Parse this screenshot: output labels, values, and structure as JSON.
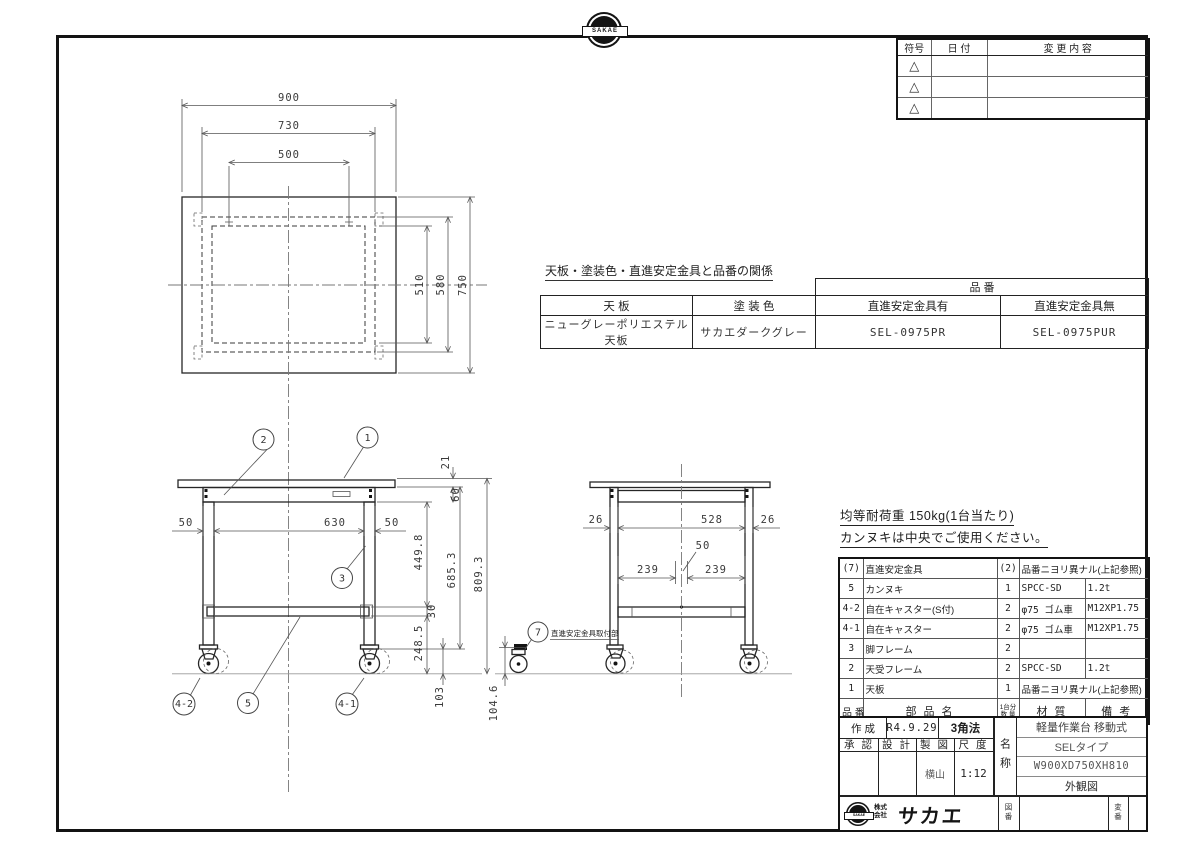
{
  "sheet": {
    "brand_logo_text": "SAKAE",
    "revision_table": {
      "col_symbol": "符号",
      "col_date": "日  付",
      "col_change": "変 更 内 容",
      "symbol_mark": "△"
    },
    "relation": {
      "caption": "天板・塗装色・直進安定金具と品番の関係",
      "part_no_header": "品  番",
      "col_top": "天 板",
      "col_paint": "塗 装 色",
      "col_with": "直進安定金具有",
      "col_without": "直進安定金具無",
      "top_value": "ニューグレーポリエステル天板",
      "paint_value": "サカエダークグレー",
      "with_value": "SEL-0975PR",
      "without_value": "SEL-0975PUR"
    },
    "notes": {
      "line1": "均等耐荷重  150kg(1台当たり)",
      "line2": "カンヌキは中央でご使用ください。"
    },
    "parts": {
      "h_no": "品 番",
      "h_name": "部 品 名",
      "h_qty1": "1台分",
      "h_qty2": "数 量",
      "h_mat": "材  質",
      "h_rem": "備  考",
      "rows": [
        {
          "no": "(7)",
          "name": "直進安定金具",
          "qty": "(2)",
          "mat": "品番ニヨリ異ナル(上記参照)",
          "rem": ""
        },
        {
          "no": "5",
          "name": "カンヌキ",
          "qty": "1",
          "mat": "SPCC-SD",
          "rem": "1.2t"
        },
        {
          "no": "4-2",
          "name": "自在キャスター(S付)",
          "qty": "2",
          "mat": "φ75 ゴム車",
          "rem": "M12XP1.75"
        },
        {
          "no": "4-1",
          "name": "自在キャスター",
          "qty": "2",
          "mat": "φ75 ゴム車",
          "rem": "M12XP1.75"
        },
        {
          "no": "3",
          "name": "脚フレーム",
          "qty": "2",
          "mat": "",
          "rem": ""
        },
        {
          "no": "2",
          "name": "天受フレーム",
          "qty": "2",
          "mat": "SPCC-SD",
          "rem": "1.2t"
        },
        {
          "no": "1",
          "name": "天板",
          "qty": "1",
          "mat": "品番ニヨリ異ナル(上記参照)",
          "rem": ""
        }
      ]
    },
    "title_block": {
      "created_label": "作 成",
      "created_value": "R4.9.29",
      "projection": "3角法",
      "approved_label": "承 認",
      "design_label": "設 計",
      "draft_label": "製 図",
      "scale_label": "尺 度",
      "draft_value": "横山",
      "scale_value": "1:12",
      "name_label": "名称",
      "product_line1": "軽量作業台 移動式",
      "product_line2": "SELタイプ",
      "product_line3": "W900XD750XH810",
      "product_line4": "外観図",
      "company_type1": "株式",
      "company_type2": "会社",
      "company_name": "サカエ",
      "logo_text": "SAKAE",
      "drawing_no_label": "図番",
      "rev_no_label": "変番"
    },
    "dims": {
      "tv_900": "900",
      "tv_730": "730",
      "tv_500": "500",
      "tv_510": "510",
      "tv_580": "580",
      "tv_750": "750",
      "fv_21": "21",
      "fv_60": "60",
      "fv_4498": "449.8",
      "fv_30": "30",
      "fv_2485": "248.5",
      "fv_103": "103",
      "fv_6853": "685.3",
      "fv_8093": "809.3",
      "fv_50l": "50",
      "fv_630": "630",
      "fv_50r": "50",
      "sv_26l": "26",
      "sv_528": "528",
      "sv_26r": "26",
      "sv_50": "50",
      "sv_239l": "239",
      "sv_239r": "239",
      "sv_1046": "104.6"
    },
    "balloons": {
      "b1": "1",
      "b2": "2",
      "b3": "3",
      "b5": "5",
      "b42": "4-2",
      "b41": "4-1",
      "b7": "7",
      "b7_label": "直進安定金具取付部"
    }
  }
}
